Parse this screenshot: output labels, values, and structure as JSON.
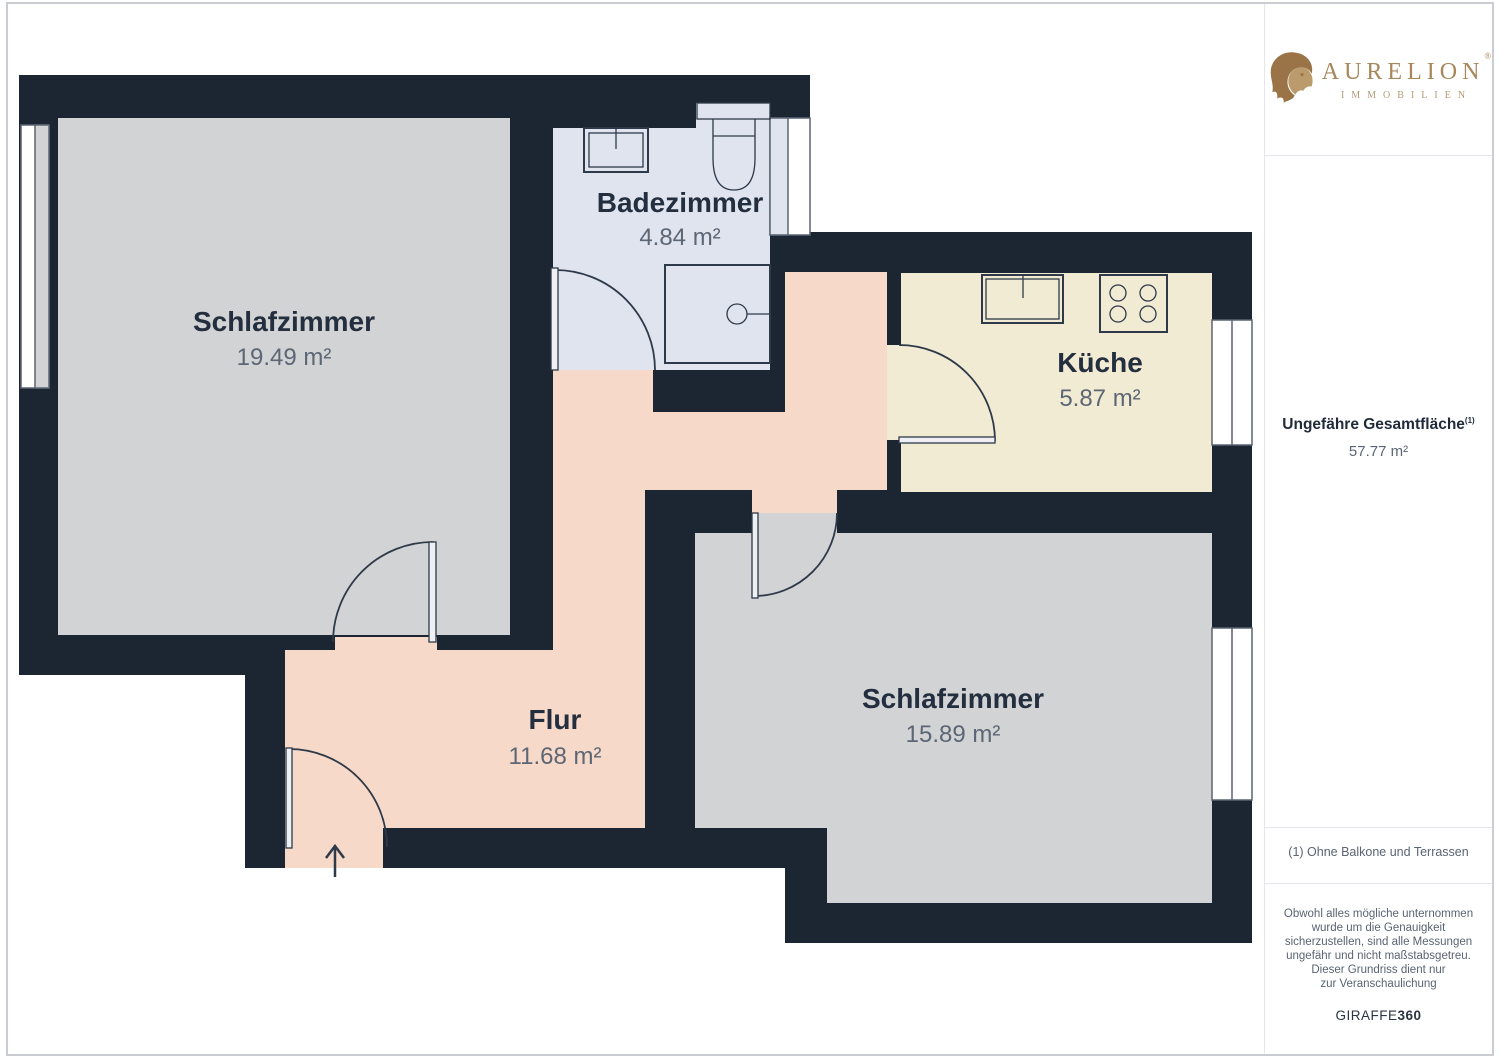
{
  "sidebar": {
    "brand": {
      "name": "AURELION",
      "registered": "®",
      "sub": "IMMOBILIEN"
    },
    "total_area": {
      "label": "Ungefähre Gesamtfläche",
      "footnote_ref": "(1)",
      "value": "57.77 m²"
    },
    "footnote": "(1) Ohne Balkone und Terrassen",
    "disclaimer_lines": [
      "Obwohl alles mögliche unternommen",
      "wurde um die Genauigkeit",
      "sicherzustellen, sind alle Messungen",
      "ungefähr und nicht maßstabsgetreu.",
      "Dieser Grundriss dient nur",
      "zur Veranschaulichung"
    ],
    "credit": {
      "normal": "GIRAFFE",
      "bold": "360"
    }
  },
  "plan": {
    "colors": {
      "wall": "#1c2532",
      "room_gray": "#d2d3d4",
      "bathroom": "#dfe4ee",
      "kitchen": "#f2ebd4",
      "hall": "#f6d9c8",
      "shower_fill": "#e7ecf4",
      "cistern_fill": "#e9edf5",
      "outline": "#2e3949",
      "window_line": "#5a6472",
      "label_color": "#232e3e",
      "value_color": "#5c6675",
      "brand_gold": "#a8875c",
      "lion_dark": "#9a7446",
      "lion_light": "#bb9a6b"
    },
    "rooms": [
      {
        "id": "schlafzimmer-1",
        "name": "Schlafzimmer",
        "area": "19.49 m²"
      },
      {
        "id": "badezimmer",
        "name": "Badezimmer",
        "area": "4.84 m²"
      },
      {
        "id": "kueche",
        "name": "Küche",
        "area": "5.87 m²"
      },
      {
        "id": "flur",
        "name": "Flur",
        "area": "11.68 m²"
      },
      {
        "id": "schlafzimmer-2",
        "name": "Schlafzimmer",
        "area": "15.89 m²"
      }
    ]
  }
}
